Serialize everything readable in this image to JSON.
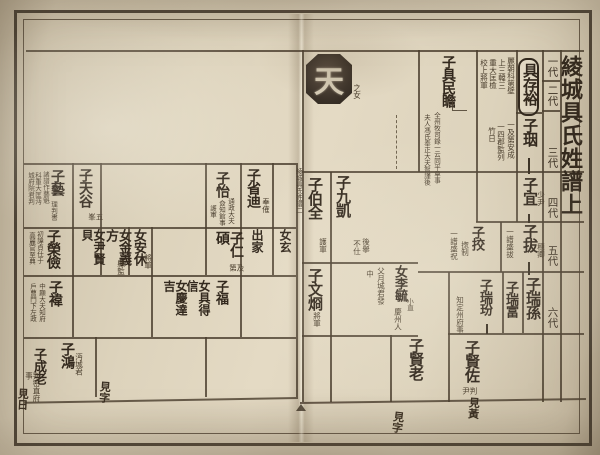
{
  "meta": {
    "title": "綾城具氏姓譜上",
    "seal": "天",
    "fold_text": "綾城具氏姓譜二",
    "ink": "#33291e",
    "paper": "#e3d9c3"
  },
  "generations": {
    "g1": "一代",
    "g2": "二代",
    "g3": "三代",
    "g4": "四代",
    "g5": "五代",
    "g6": "六代"
  },
  "right": {
    "junyu": {
      "name": "具存裕",
      "n1": "麗朝科第壁",
      "n2": "上三韓三",
      "n3": "重大匡檢",
      "n4": "校上將軍"
    },
    "minseom": {
      "name": "子具民瞻",
      "n1": "全州牧司錄一云同平章事",
      "n2": "夫人馮氏奉正大夫智謹後",
      "n3": "之女"
    },
    "yeon": {
      "name": "子珚",
      "n1": "一及第安成",
      "n2": "一四郡監列",
      "n3": "竹日"
    },
    "ui": {
      "name": "子宜",
      "n1": "少尹"
    },
    "bal": {
      "name": "子拔",
      "n1": "穗卿",
      "n2": "一譜盛拔"
    },
    "gyo": {
      "name": "子挍",
      "n1": "揔制",
      "n2": "一譜盛祝"
    },
    "seoson": {
      "name": "子瑞孫"
    },
    "seobu": {
      "name": "子瑞富"
    },
    "seobun": {
      "name": "子瑞玢",
      "n1": "知定州府事"
    },
    "gukae": {
      "name": "子九凱",
      "n1": "後擧",
      "n2": "不仕"
    },
    "baekjeon": {
      "name": "子伯全",
      "n1": "護軍"
    },
    "mungyeong": {
      "name": "子文烱",
      "n1": "將軍"
    },
    "ladylee": {
      "name": "女李毓",
      "n1": "小直",
      "n2": "父月城君發",
      "n3": "中",
      "n4": "慶州人"
    },
    "hyeonjwa": {
      "name": "子賢佐",
      "n1": "判尹"
    },
    "hyeonro": {
      "name": "子賢老"
    },
    "marker1": "見黃",
    "marker2": "見字"
  },
  "left": {
    "ye": {
      "name": "子藝",
      "n1": "諸譜作藝魁",
      "n2": "科重大匡沔",
      "n3": "城府院君判",
      "n4": "理判書"
    },
    "cheongok": {
      "name": "子天谷",
      "n1": "五峯"
    },
    "i": {
      "name": "子怡",
      "n1": "通政大夫",
      "n2": "僉知館事",
      "n3": "護軍"
    },
    "seongjeok": {
      "name": "子省迪",
      "n1": "奉傕"
    },
    "chulga": "出家",
    "hyeonnyeo": "女玄",
    "inseok": {
      "name": "子仁碩",
      "n1": "及第"
    },
    "yunhyeon": "女尹賢貝",
    "anhyu": {
      "name": "女安休",
      "n1": "將軍"
    },
    "kimuibang": {
      "name": "女金義方",
      "n1": "縣監"
    },
    "yeonggeom": {
      "name": "子榮儉",
      "n1": "初諱貞仕于",
      "n2": "高麗官至典"
    },
    "bok": "子福",
    "gudeuksin": "女具得信",
    "gyeongdalgil": "女慶達吉",
    "wi": {
      "name": "子褘",
      "n1": "中顯大夫知府",
      "n2": "戶曹門下左政"
    },
    "hong": {
      "name": "子鴻",
      "n1": "沔城君"
    },
    "seongro": {
      "name": "子成老",
      "n1": "判密直府事"
    },
    "marker1": "見日",
    "marker2": "見字"
  }
}
